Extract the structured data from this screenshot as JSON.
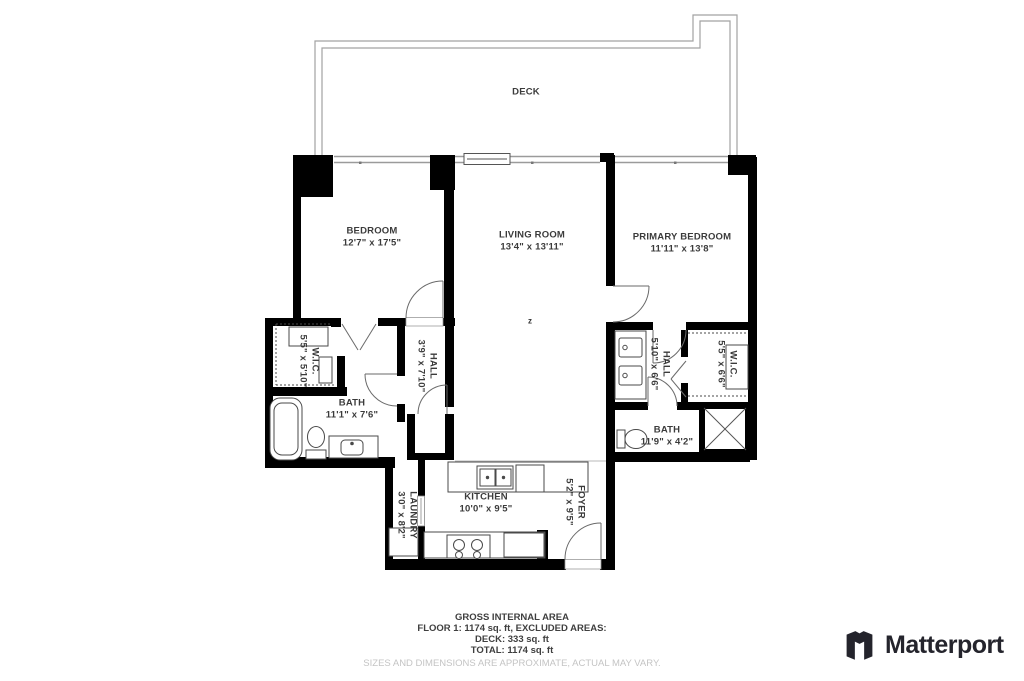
{
  "plan": {
    "marker": "z",
    "rooms": [
      {
        "id": "deck",
        "name": "DECK",
        "dims": ""
      },
      {
        "id": "bedroom",
        "name": "BEDROOM",
        "dims": "12'7\" x 17'5\""
      },
      {
        "id": "living-room",
        "name": "LIVING ROOM",
        "dims": "13'4\" x 13'11\""
      },
      {
        "id": "primary-bedroom",
        "name": "PRIMARY BEDROOM",
        "dims": "11'11\" x 13'8\""
      },
      {
        "id": "wic-left",
        "name": "W.I.C.",
        "dims": "5'5\" x 5'10\""
      },
      {
        "id": "hall-left",
        "name": "HALL",
        "dims": "3'9\" x 7'10\""
      },
      {
        "id": "bath-left",
        "name": "BATH",
        "dims": "11'1\" x 7'6\""
      },
      {
        "id": "hall-right",
        "name": "HALL",
        "dims": "5'10\" x 6'6\""
      },
      {
        "id": "wic-right",
        "name": "W.I.C.",
        "dims": "5'5\" x 6'6\""
      },
      {
        "id": "bath-right",
        "name": "BATH",
        "dims": "11'9\" x 4'2\""
      },
      {
        "id": "laundry",
        "name": "LAUNDRY",
        "dims": "3'0\" x 8'2\""
      },
      {
        "id": "kitchen",
        "name": "KITCHEN",
        "dims": "10'0\" x 9'5\""
      },
      {
        "id": "foyer",
        "name": "FOYER",
        "dims": "5'2\" x 9'5\""
      }
    ]
  },
  "footer": {
    "line1": "GROSS INTERNAL AREA",
    "line2": "FLOOR 1: 1174 sq. ft, EXCLUDED AREAS:",
    "line3": "DECK: 333 sq. ft",
    "line4": "TOTAL: 1174 sq. ft",
    "disclaimer": "SIZES AND DIMENSIONS ARE APPROXIMATE, ACTUAL MAY VARY."
  },
  "branding": {
    "logo_text": "Matterport"
  },
  "colors": {
    "wall": "#000000",
    "thin_line": "#9b9b9b",
    "text": "#3b3b3b",
    "disclaimer": "#c4c4c4",
    "logo": "#24242c"
  }
}
